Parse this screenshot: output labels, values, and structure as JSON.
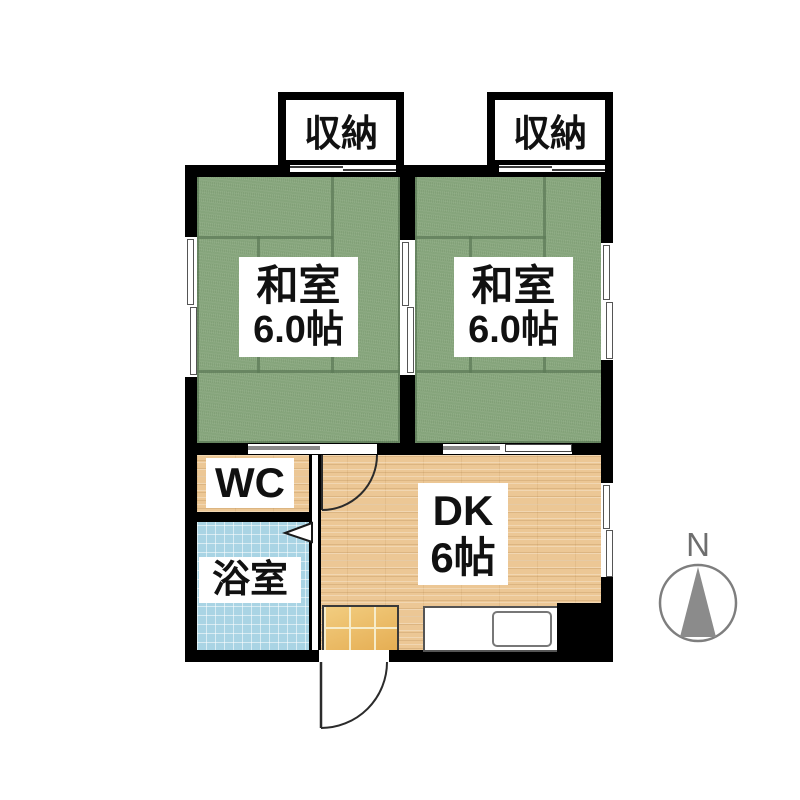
{
  "floorplan": {
    "closet_left_label": "収納",
    "closet_right_label": "収納",
    "room_left": {
      "name": "和室",
      "size": "6.0帖"
    },
    "room_right": {
      "name": "和室",
      "size": "6.0帖"
    },
    "wc_label": "WC",
    "bath_label": "浴室",
    "dk": {
      "name": "DK",
      "size": "6帖"
    },
    "compass_label": "N",
    "colors": {
      "wall": "#000000",
      "tatami_green": "#8BA980",
      "wood_floor": "#ECC795",
      "bath_tile_blue": "#A9D4E4",
      "genkan_tile_orange": "#EDBA5F",
      "compass_gray": "#8B8B8B"
    }
  }
}
